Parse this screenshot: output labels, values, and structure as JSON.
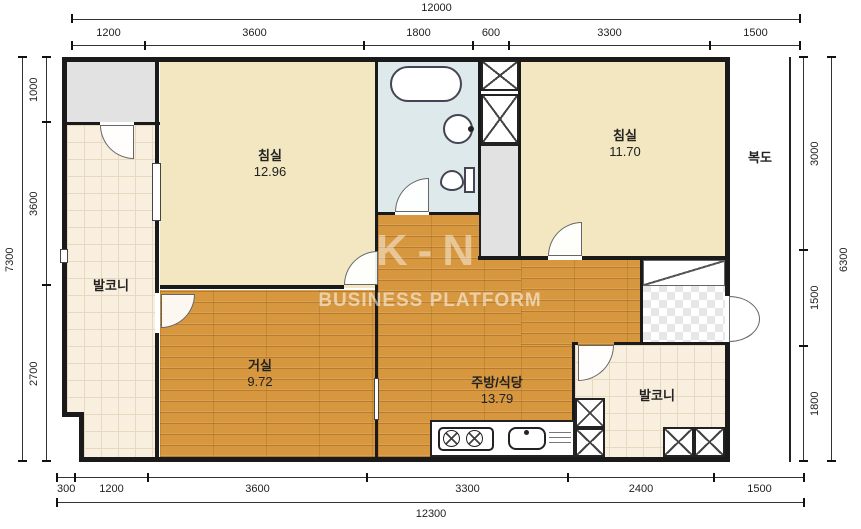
{
  "watermark": {
    "brand": "BUSINESS PLATFORM",
    "logo_text": "K-N"
  },
  "rooms": {
    "bedroom_top_left": {
      "name": "침실",
      "area": "12.96"
    },
    "bedroom_top_right": {
      "name": "침실",
      "area": "11.70"
    },
    "living": {
      "name": "거실",
      "area": "9.72"
    },
    "kitchen": {
      "name": "주방/식당",
      "area": "13.79"
    },
    "balcony_left": {
      "name": "발코니"
    },
    "balcony_bottom": {
      "name": "발코니"
    },
    "corridor": {
      "name": "복도"
    }
  },
  "dimensions": {
    "top": {
      "total": "12000",
      "segments": [
        "1200",
        "3600",
        "1800",
        "600",
        "3300",
        "1500"
      ]
    },
    "bottom": {
      "total": "12300",
      "segments": [
        "300",
        "1200",
        "3600",
        "3300",
        "2400",
        "1500"
      ]
    },
    "left": {
      "total": "7300",
      "segments": [
        "1000",
        "3600",
        "2700"
      ]
    },
    "right": {
      "total": "6300",
      "segments": [
        "3000",
        "1500",
        "1800"
      ]
    }
  },
  "colors": {
    "wall": "#1a1a1a",
    "wood": "#d6973f",
    "cream": "#f2e7c0",
    "tile": "#f9efdf",
    "bath_floor": "#dde9ea"
  }
}
